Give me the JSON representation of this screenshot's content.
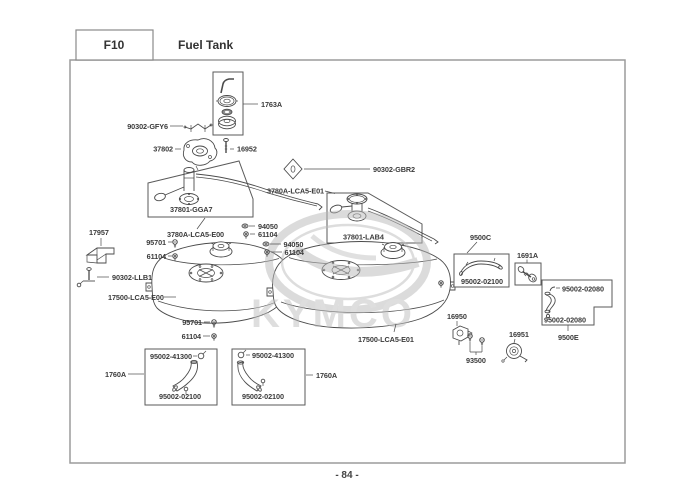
{
  "header": {
    "code": "F10",
    "title": "Fuel Tank"
  },
  "footer": {
    "page_number": "- 84 -"
  },
  "watermark": {
    "brand": "KYMCO"
  },
  "parts": {
    "cap_assembly": "1763A",
    "clip_gfy6": "90302-GFY6",
    "flange_37802": "37802",
    "screw_16952": "16952",
    "sender_left": "37801-GGA7",
    "sender_kit_left": "3780A-LCA5-E00",
    "sender_right": "37801-LAB4",
    "sender_kit_right": "3780A-LCA5-E01",
    "clip_gbr2": "90302-GBR2",
    "screw_95701": "95701",
    "bolt_61104": "61104",
    "washer_94050": "94050",
    "bracket_17957": "17957",
    "bolt_llb1": "90302-LLB1",
    "tank_left": "17500-LCA5-E00",
    "tank_right": "17500-LCA5-E01",
    "hose_kit_9500c": "9500C",
    "hose_02100": "95002-02100",
    "joint_1691a": "1691A",
    "hose_kit_9500e": "9500E",
    "hose_02080": "95002-02080",
    "clip_41300": "95002-41300",
    "tube_kit_1760a": "1760A",
    "valve_16950": "16950",
    "screw_93500": "93500",
    "cock_16951": "16951"
  }
}
